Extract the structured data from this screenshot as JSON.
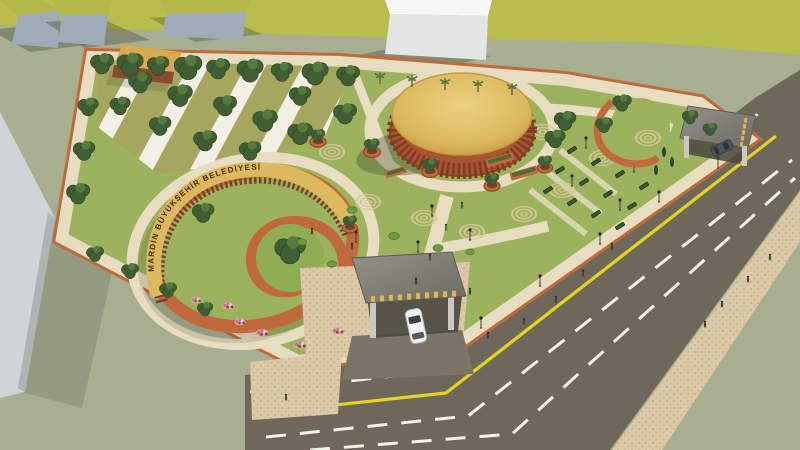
{
  "scene": {
    "description": "Aerial 3D architectural rendering of a public park landscape design beside a road",
    "signs": {
      "spiral_wall_text": "MARDİN BÜYÜKŞEHİR BELEDİYESİ"
    },
    "objects": {
      "pavilion": "circular pavilion with golden roof and timber slat columns",
      "spiral_monument": "spiral terracotta wall with golden sign band",
      "main_gate": "stone canopy entrance gate with gold letters and white car",
      "side_gate": "secondary canopy gate with gold letters and dark car",
      "road": "asphalt road with white dashed lanes and solid yellow line"
    }
  },
  "colors": {
    "ground_sage": "#a8ae90",
    "field_olive": "#b9bd4b",
    "lawn_green": "#9db25c",
    "path_cream": "#e7ddc1",
    "terracotta": "#c06a3c",
    "gold": "#dcb95e",
    "road_asphalt": "#6e685b",
    "lane_yellow": "#e6d31f",
    "lane_white": "#f2f1ea",
    "sidewalk_tan": "#dbc9a8",
    "tree_green": "#3f5e33",
    "flower_pink": "#c4699c",
    "flower_red": "#b4404a",
    "canopy_gray": "#82817b",
    "car_white": "#eef1f1"
  }
}
